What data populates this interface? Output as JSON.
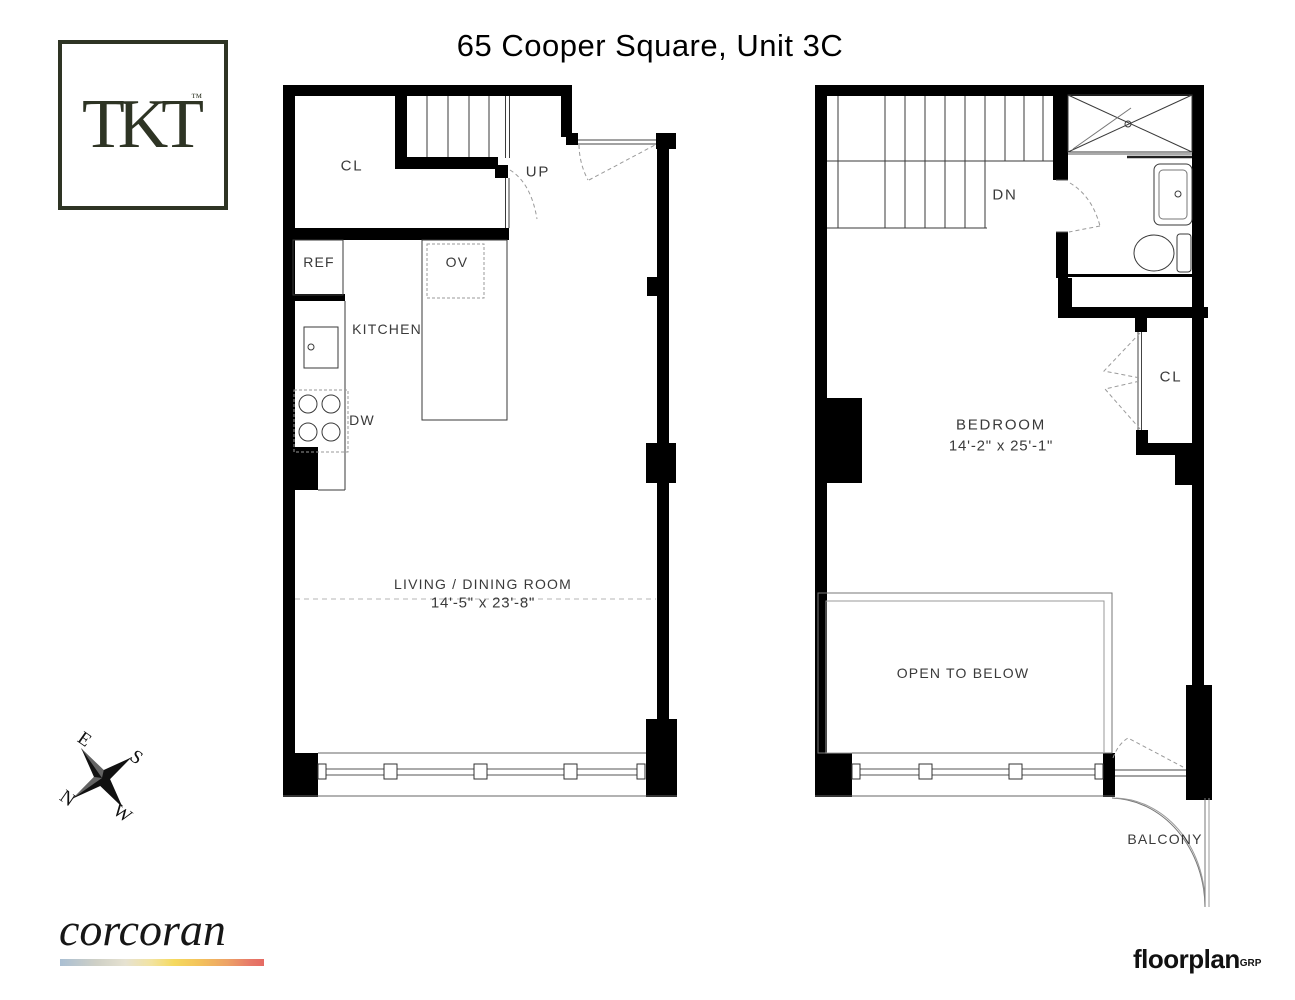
{
  "title": "65 Cooper Square, Unit 3C",
  "branding": {
    "tkt_logo_text": "TKT",
    "tkt_trademark": "™",
    "corcoran_wordmark": "corcoran",
    "floorplan_wordmark": "floorplan",
    "floorplan_wordmark_suffix": "GRP"
  },
  "compass": {
    "north": "N",
    "east": "E",
    "south": "S",
    "west": "W"
  },
  "lower_level": {
    "closet_label": "CL",
    "stairs_label": "UP",
    "refrigerator_label": "REF",
    "oven_label": "OV",
    "kitchen_label": "KITCHEN",
    "dishwasher_label": "DW",
    "room_label": "LIVING / DINING ROOM",
    "room_dimensions": "14'-5\" x 23'-8\""
  },
  "upper_level": {
    "stairs_label": "DN",
    "closet_label": "CL",
    "room_label": "BEDROOM",
    "room_dimensions": "14'-2\" x 25'-1\"",
    "open_to_below_label": "OPEN TO BELOW",
    "balcony_label": "BALCONY"
  },
  "colors": {
    "wall": "#000000",
    "line": "#3a3a3a",
    "logo_green": "#2e3424",
    "corcoran_gradient": [
      "#aabfd3",
      "#e6e2d1",
      "#f5d95e",
      "#eda266",
      "#e56a63"
    ]
  }
}
